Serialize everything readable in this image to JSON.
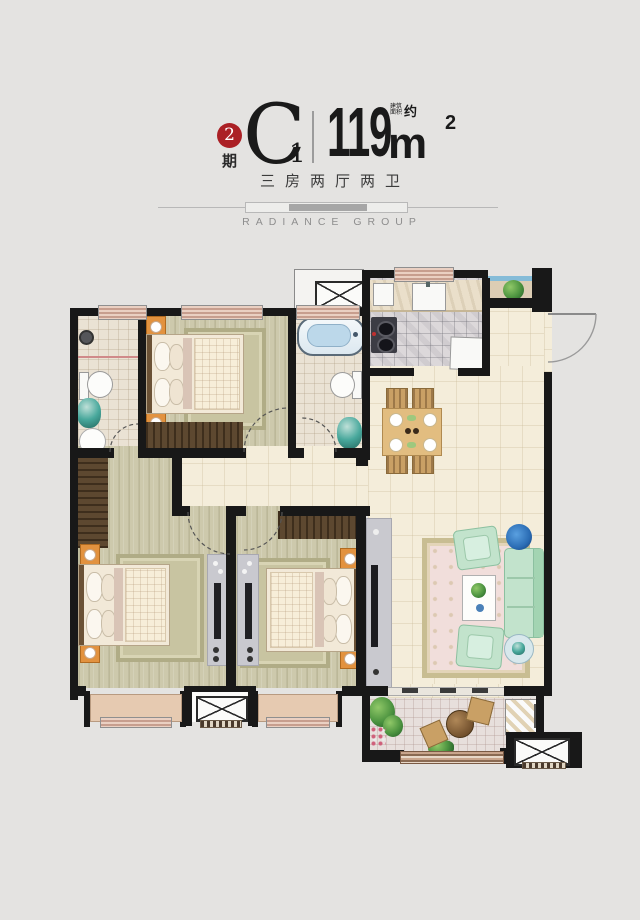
{
  "header": {
    "phase_number": "2",
    "phase_label": "期",
    "unit_letter": "C",
    "unit_sub": "1",
    "area_value": "119",
    "area_unit": "m",
    "area_sup": "2",
    "area_note_line1": "建筑",
    "area_note_line2": "面积",
    "area_note_approx": "约",
    "subtitle": "三房两厅两卫",
    "brand": "RADIANCE GROUP"
  },
  "colors": {
    "background": "#e4e3e1",
    "badge_red": "#ab2025",
    "wall_black": "#181818",
    "window_pink": "#e7c9ba",
    "floor_wood": "#cdc9ac",
    "floor_tile_cream": "#f4edda",
    "sofa_mint": "#c2e3cc",
    "nightstand_orange": "#e2923f"
  }
}
